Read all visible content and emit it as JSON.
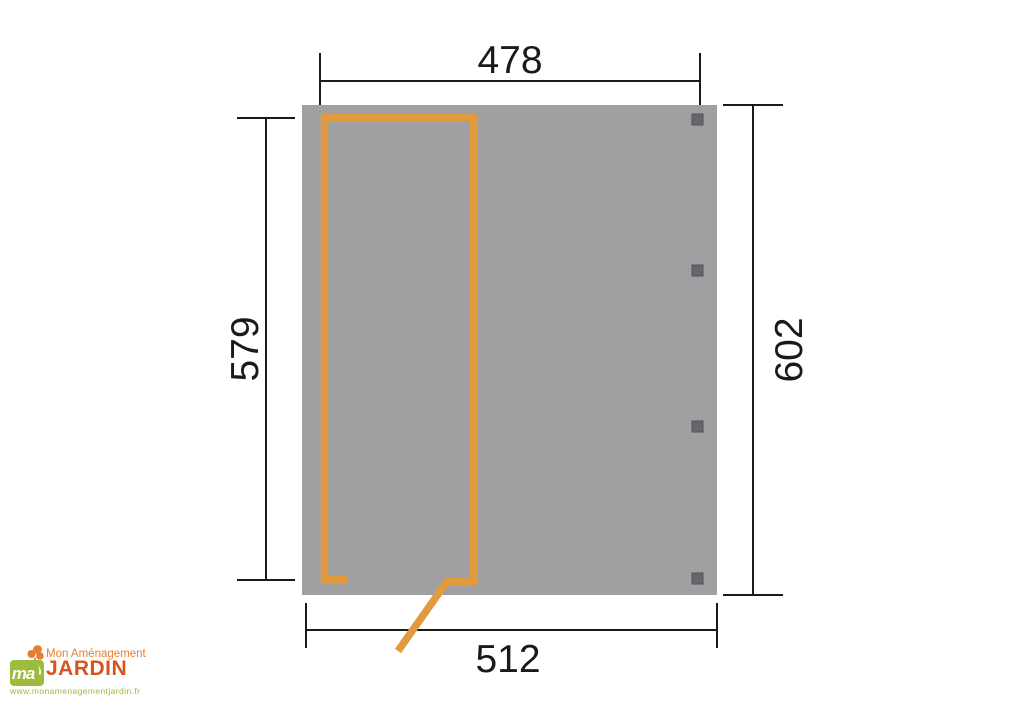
{
  "diagram": {
    "description": "Top-view dimension drawing of a garden shelter / carport panel",
    "dimensions": {
      "top": "478",
      "left": "579",
      "right": "602",
      "bottom": "512"
    },
    "posts_count": 4,
    "colors": {
      "panel": "#9EA0A2",
      "door_outline": "#E29A3E",
      "post": "#65676A",
      "dimension_lines": "#1A1A1A"
    }
  },
  "logo": {
    "tagline": "Mon Aménagement",
    "name": "JARDIN",
    "monogram": "ma",
    "website": "www.monamenagementjardin.fr",
    "colors": {
      "green": "#9DBB3D",
      "orange": "#E87E2D",
      "brand": "#D8541E"
    }
  }
}
